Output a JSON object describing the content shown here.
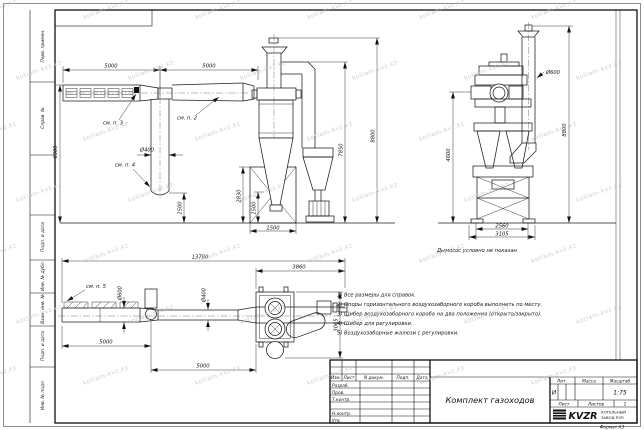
{
  "watermark": {
    "text": "kotlam-kvz.kz"
  },
  "sheet": {
    "format_note": "Формат А3"
  },
  "margin_stamps": {
    "top": [
      "Перв. примен.",
      "Справ. №"
    ],
    "bottom": [
      "Подп. и дата",
      "Инв. № дубл.",
      "Взам. инв. №",
      "Подп. и дата",
      "Инв. № подл."
    ]
  },
  "notes": {
    "lines": [
      "1) Все размеры для справок.",
      "2) Опоры горизонтального воздухозаборного короба выполнить по месту.",
      "3) Шибер воздухозаборного короба на два положения (открыто/закрыто).",
      "4) Шибер для регулировки.",
      "5) Воздухозаборные жалюзи с регулировки."
    ]
  },
  "captions": {
    "fan_hidden": "Дымосос условно не показан"
  },
  "title_block": {
    "header_cells": [
      "Изм.",
      "Лист",
      "N докум.",
      "Подп.",
      "Дата"
    ],
    "sign_rows": [
      "Разраб.",
      "Пров.",
      "Т.контр.",
      "Н.контр.",
      "Утв."
    ],
    "doc_title": "Комплект газоходов",
    "lit_header": "Лит.",
    "mass_header": "Масса",
    "scale_header": "Масштаб",
    "lit_value": "И",
    "scale_value": "1:75",
    "sheet_label": "Лист",
    "sheets_label": "Листов",
    "sheets_value": "1",
    "company": {
      "logo": "KVZR",
      "line1": "КОТЕЛЬНЫЙ",
      "line2": "ЗАВОД РЭП"
    }
  },
  "view_front": {
    "dims": {
      "span1": "5000",
      "span2": "5000",
      "height": "6300",
      "pipe_d": "Ø400",
      "drop": "1500",
      "duct_h": "7850",
      "stack_h": "8800",
      "stand_h": "2830",
      "cone_h": "1500",
      "stand_w": "1500"
    },
    "labels": {
      "p2": "см. п. 2",
      "p3": "см. п. 3",
      "p4": "см. п. 4"
    }
  },
  "view_side": {
    "dims": {
      "stack_d": "Ø600",
      "total_h": "8800",
      "body_h": "4600",
      "base_w": "2560",
      "total_w": "3105"
    }
  },
  "view_plan": {
    "dims": {
      "total_l": "13700",
      "right_l": "3860",
      "duct_d1": "Ø600",
      "duct_d2": "Ø400",
      "span1": "5000",
      "span2": "5000",
      "width": "3065"
    },
    "labels": {
      "p5": "см. п. 5"
    }
  }
}
